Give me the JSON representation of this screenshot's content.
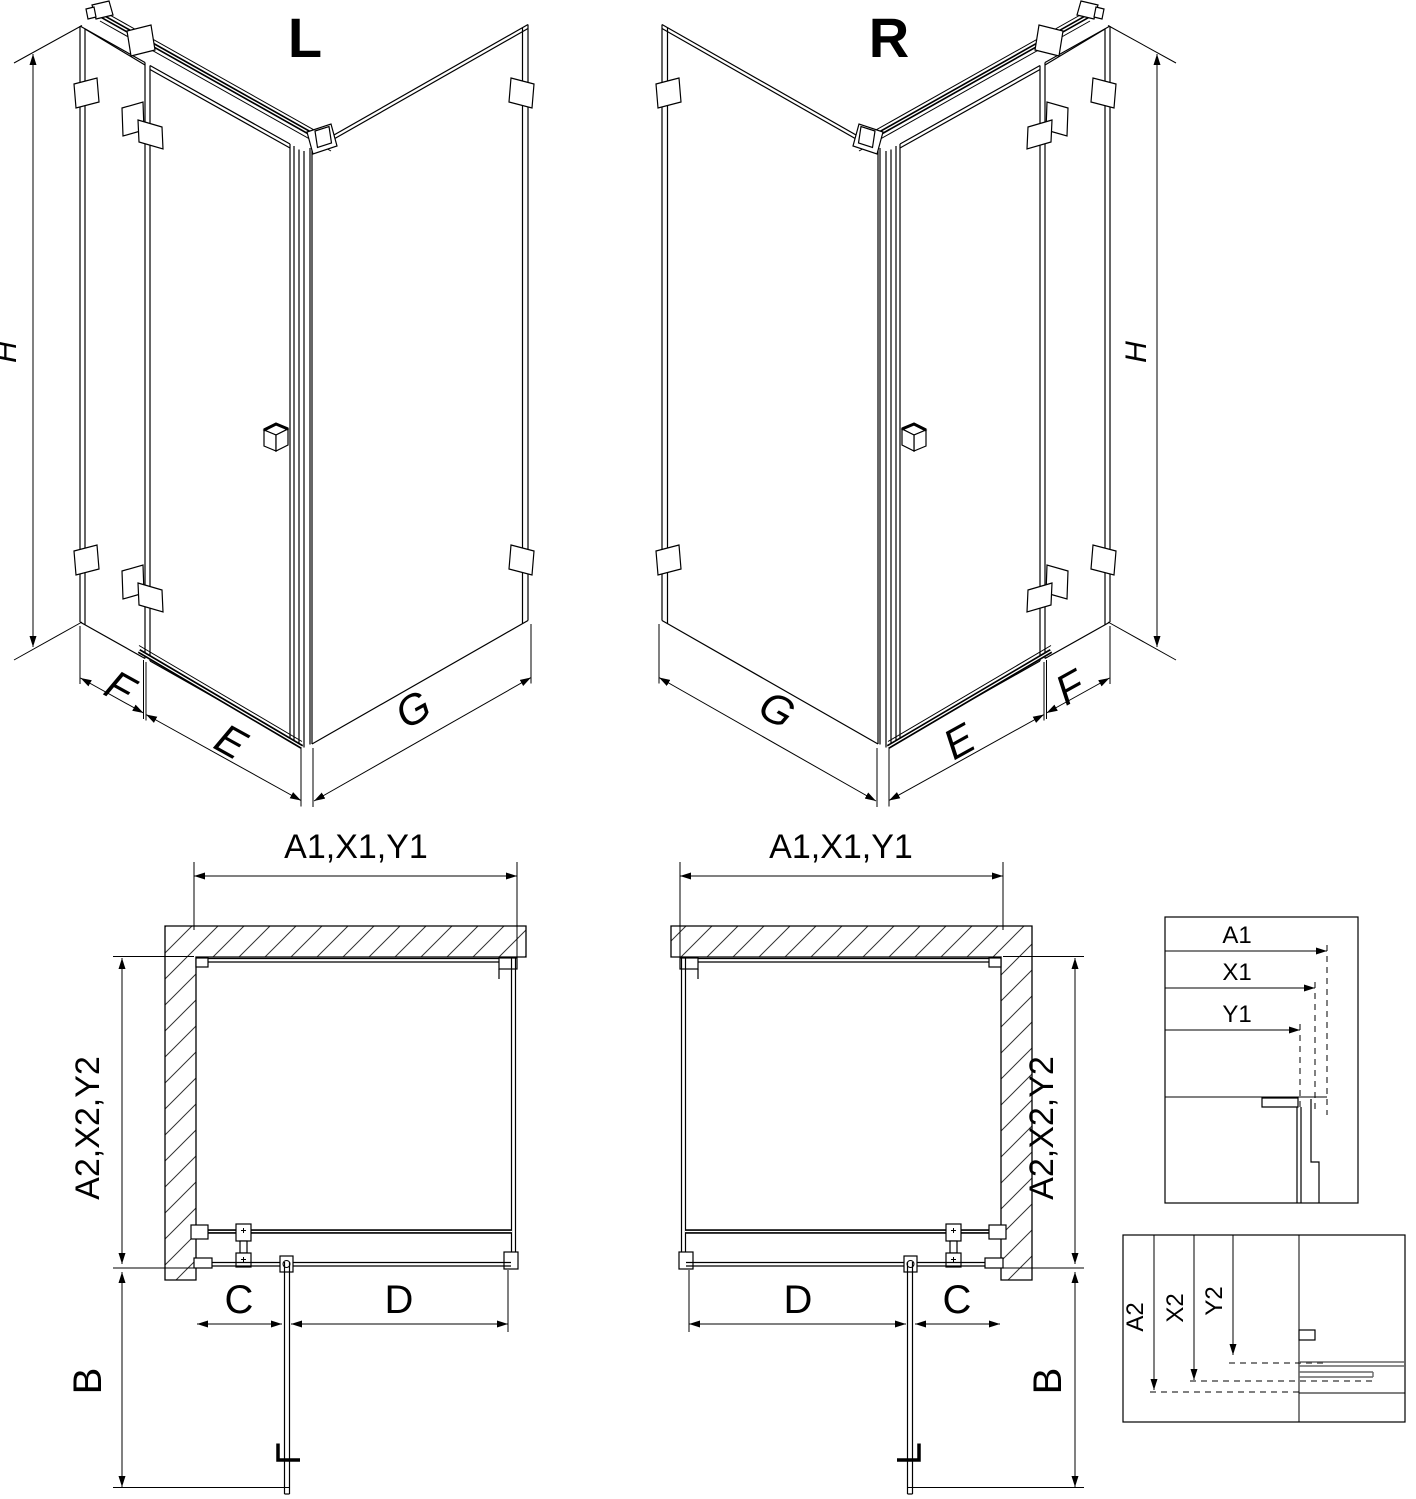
{
  "iso": {
    "left": {
      "title": "L",
      "h": "H",
      "f": "F",
      "e": "E",
      "g": "G"
    },
    "right": {
      "title": "R",
      "h": "H",
      "f": "F",
      "e": "E",
      "g": "G"
    }
  },
  "plan": {
    "left": {
      "width": "A1,X1,Y1",
      "depth": "A2,X2,Y2",
      "c": "C",
      "d": "D",
      "b": "B"
    },
    "right": {
      "width": "A1,X1,Y1",
      "depth": "A2,X2,Y2",
      "c": "C",
      "d": "D",
      "b": "B"
    }
  },
  "details": {
    "width": {
      "a1": "A1",
      "x1": "X1",
      "y1": "Y1"
    },
    "depth": {
      "a2": "A2",
      "x2": "X2",
      "y2": "Y2"
    }
  },
  "colors": {
    "line": "#000000",
    "profile_gray": "#666666",
    "background": "#ffffff"
  }
}
